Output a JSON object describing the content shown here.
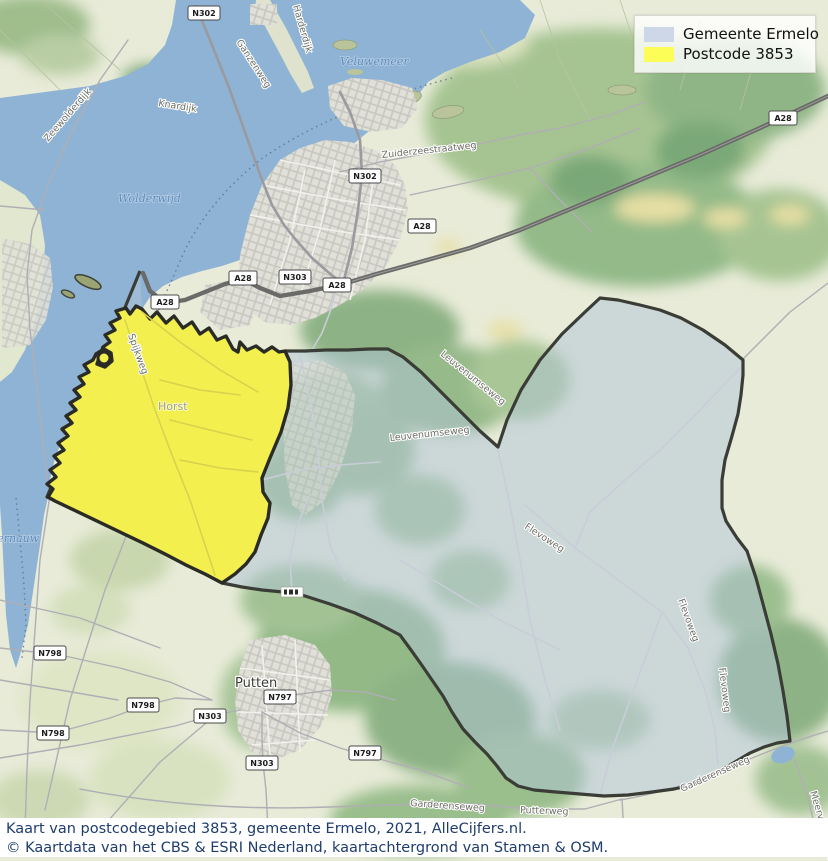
{
  "legend": {
    "items": [
      {
        "label": "Gemeente Ermelo",
        "color": "#cdd7e8"
      },
      {
        "label": "Postcode 3853",
        "color": "#fdfd57"
      }
    ]
  },
  "caption": {
    "line1": "Kaart van postcodegebied 3853, gemeente Ermelo, 2021, AlleCijfers.nl.",
    "line2": "© Kaartdata van het CBS & ESRI Nederland, kaartachtergrond van Stamen & OSM."
  },
  "map": {
    "regions": [
      {
        "name": "Gemeente Ermelo",
        "fill": "rgba(176,196,216,0.5)",
        "stroke": "#3a3d36"
      },
      {
        "name": "Postcode 3853",
        "fill": "#f2ef4e",
        "stroke": "#2b2b26"
      }
    ],
    "water_color": "#8fb3d4",
    "labels": {
      "veluwemeer": "Veluwemeer",
      "wolderwijd": "Wolderwijd",
      "nuldernauw": "Nuldernauw",
      "knardijk": "Knardijk",
      "zeewolderdijk": "Zeewolderdijk",
      "ganzenweg": "Ganzenweg",
      "harderdijk": "Harderdijk",
      "zuiderzeestraatweg": "Zuiderzeestraatweg",
      "spijkweg": "Spijkweg",
      "horst": "Horst",
      "putten": "Putten",
      "leuvenumseweg1": "Leuvenumseweg",
      "leuvenumseweg2": "Leuvenumseweg",
      "flevoweg1": "Flevoweg",
      "flevoweg2": "Flevoweg",
      "flevoweg3": "Flevoweg",
      "garderenseweg1": "Garderenseweg",
      "garderenseweg2": "Garderenseweg",
      "putterweg": "Putterweg",
      "meervelderweg": "Meervelderweg"
    },
    "shields": {
      "n302a": "N302",
      "n302b": "N302",
      "a28a": "A28",
      "a28b": "A28",
      "a28c": "A28",
      "a28d": "A28",
      "a28e": "A28",
      "n303a": "N303",
      "n303b": "N303",
      "n303c": "N303",
      "n798a": "N798",
      "n798b": "N798",
      "n798c": "N798",
      "n797a": "N797",
      "n797b": "N797"
    }
  }
}
